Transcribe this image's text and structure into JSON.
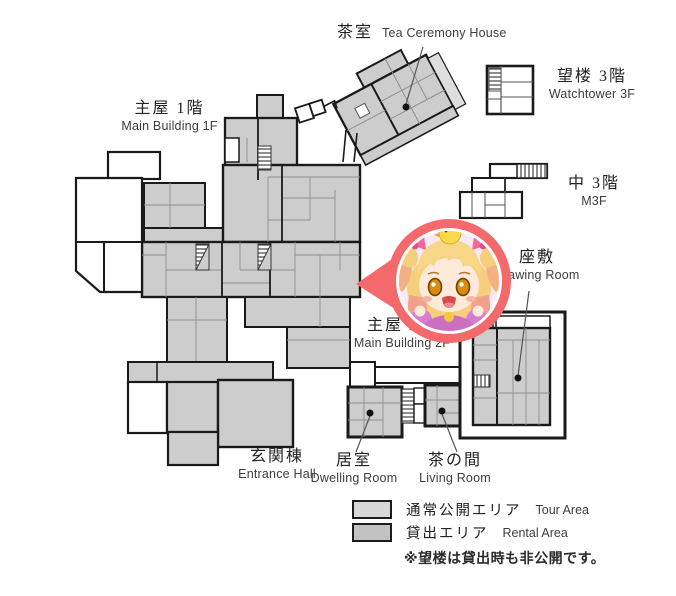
{
  "labels": {
    "tea_house": {
      "jp": "茶室",
      "en": "Tea Ceremony House"
    },
    "watchtower": {
      "jp": "望楼 3階",
      "en": "Watchtower 3F"
    },
    "m3f": {
      "jp": "中 3階",
      "en": "M3F"
    },
    "main_1f": {
      "jp": "主屋 1階",
      "en": "Main Building 1F"
    },
    "main_2f": {
      "jp": "主屋 2階",
      "en": "Main Building 2F"
    },
    "drawing_room": {
      "jp": "座敷",
      "en": "Drawing Room"
    },
    "dwelling_room": {
      "jp": "居室",
      "en": "Dwelling Room"
    },
    "living_room": {
      "jp": "茶の間",
      "en": "Living Room"
    },
    "entrance_hall": {
      "jp": "玄関棟",
      "en": "Entrance Hall"
    }
  },
  "legend": {
    "items": [
      {
        "jp": "通常公開エリア",
        "en": "Tour Area",
        "color": "#d6d6d6"
      },
      {
        "jp": "貸出エリア",
        "en": "Rental Area",
        "color": "#c2c2c2"
      }
    ],
    "note": "※望楼は貸出時も非公開です。"
  },
  "marker": {
    "type": "character-map-pin",
    "pin_color": "#f4696b",
    "inner_bg": "#fbe9f1"
  },
  "colors": {
    "room_gray": "#cdcdcd",
    "outline": "#1a1a1a",
    "thin_line": "#8f8f8f",
    "leader_line": "#555555"
  }
}
